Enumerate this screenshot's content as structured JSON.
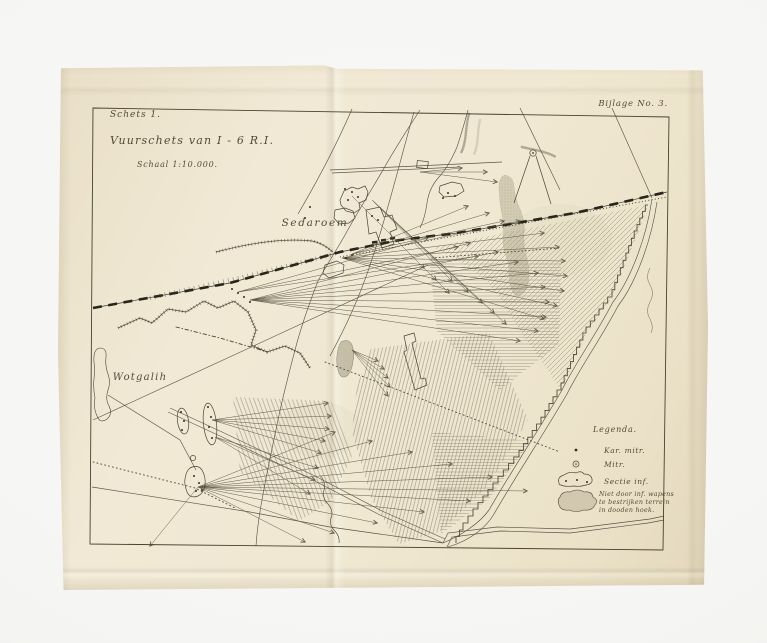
{
  "photo": {
    "backdrop_color": "#f5f5f3",
    "paper_color": "#f0e8d2",
    "ink_color": "#4a4434",
    "railway_color": "#28241b",
    "hatch_color": "#8f8874",
    "shade_color": "#b3aa90"
  },
  "header": {
    "schets": "Schets 1.",
    "title": "Vuurschets van I - 6 R.I.",
    "scale": "Schaal 1:10.000.",
    "bijlage": "Bijlage No. 3."
  },
  "map": {
    "place_labels": [
      {
        "name": "Sedaroem"
      },
      {
        "name": "Wotgalih"
      }
    ]
  },
  "legend": {
    "title": "Legenda.",
    "items": [
      {
        "symbol": "kar-mitr-dot",
        "label": "Kar. mitr."
      },
      {
        "symbol": "mitr-circle",
        "label": "Mitr."
      },
      {
        "symbol": "sectie-inf-oval",
        "label": "Sectie inf."
      },
      {
        "symbol": "dead-angle-blob",
        "label": "Niet door inf. wapens te bestrijken terrein in dooden hoek.",
        "label_lines": [
          "Niet door inf. wapens",
          "te bestrijken terrein",
          "in dooden hoek."
        ]
      }
    ]
  }
}
